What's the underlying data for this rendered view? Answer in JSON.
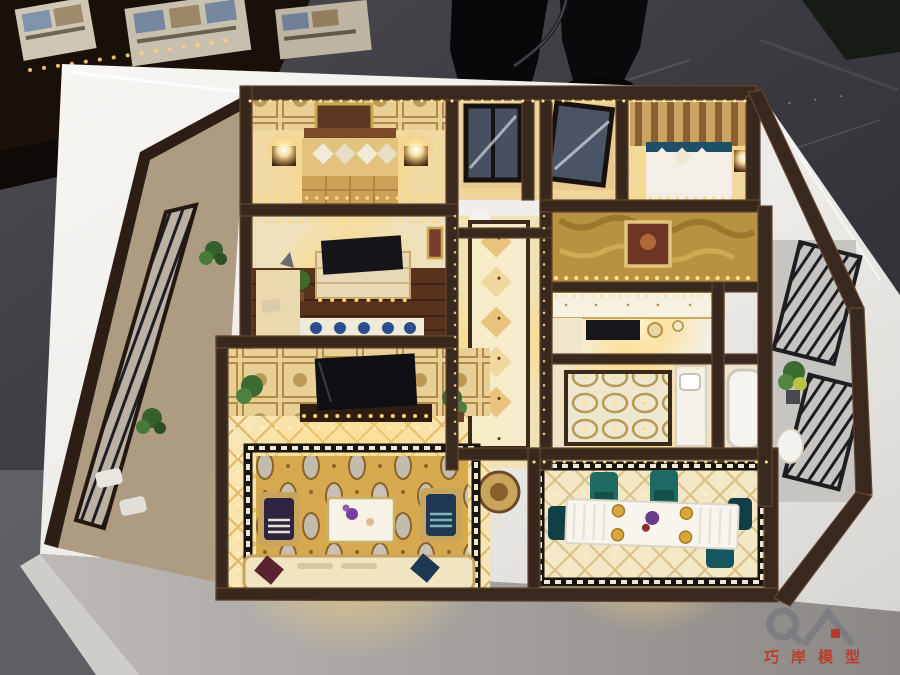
{
  "meta": {
    "type": "photograph",
    "description": "Bird's-eye photograph of an illuminated luxury-apartment interior scale model, displayed on a glossy white platform in a showroom. A visitor's legs are visible at the top edge on a dark marble floor; a second display table with framed floor plans sits top-left; a QA / Qiao'an Models watermark is in the bottom-right corner."
  },
  "environment": {
    "floor": "dark grey marble showroom floor",
    "bystander": "standing person (black trousers, legs only)",
    "side_table": "dark display table with small lit floor-plan cards",
    "column": "dark stone column base (top right)"
  },
  "model": {
    "base": "glossy white acrylic platform",
    "style": "warm LED-lit luxury flat, dark walnut walls, gold-toned interiors",
    "rooms": [
      {
        "name": "master-bedroom",
        "details": "gold bed with diamond pillows, twin glowing nightstand lamps, framed artwork on damask wall"
      },
      {
        "name": "glass-wardrobe",
        "details": "black-framed glass sliding doors, one panel ajar"
      },
      {
        "name": "second-bedroom",
        "details": "vertical wood-slat headboard wall, white and teal bedding, lit bedside lamp"
      },
      {
        "name": "study-bedroom",
        "details": "TV dresser with candles, corner desk, potted plant, blue patterned rug, dark wood floor"
      },
      {
        "name": "foyer",
        "details": "gilt textured feature wall with framed painting, diamond runner rug"
      },
      {
        "name": "kitchen",
        "details": "white and gold cabinetry, black cooktop counter"
      },
      {
        "name": "bathroom",
        "details": "oval-patterned marble floor, white vanity and tub"
      },
      {
        "name": "living-room",
        "details": "damask TV feature wall, widescreen TV, crystal-lit diamond tile floor, gold brocade carpet, white coffee table with purple flowers, armchairs, sofa"
      },
      {
        "name": "dining-room",
        "details": "long white banquet table, gold chargers, teal upholstered chairs, greek-key floor border"
      },
      {
        "name": "balconies",
        "details": "black wrought-iron railings with green plants on left and right sides"
      }
    ]
  },
  "watermark": {
    "logo": "QA",
    "tagline_lines": [
      "Q An'an",
      "Models",
      "Design"
    ],
    "brand": "巧岸模型"
  },
  "palette": {
    "marble_dark": "#2f2e33",
    "marble_light": "#57565c",
    "base_white": "#f4f2ef",
    "base_shadow": "#8e8b88",
    "wall_brown": "#38281d",
    "wall_highlight": "#6b4c38",
    "room_gold": "#f0d9a2",
    "glow_yellow": "#ffd978",
    "led_amber": "#ffbf55",
    "carpet_gold": "#d7a94f",
    "accent_teal": "#1f6b63",
    "accent_purple": "#7a3f9e",
    "glass_blue": "#465060",
    "wood_floor": "#53331f",
    "watermark_grey": "#85858a",
    "watermark_red": "#bf3a2b"
  }
}
